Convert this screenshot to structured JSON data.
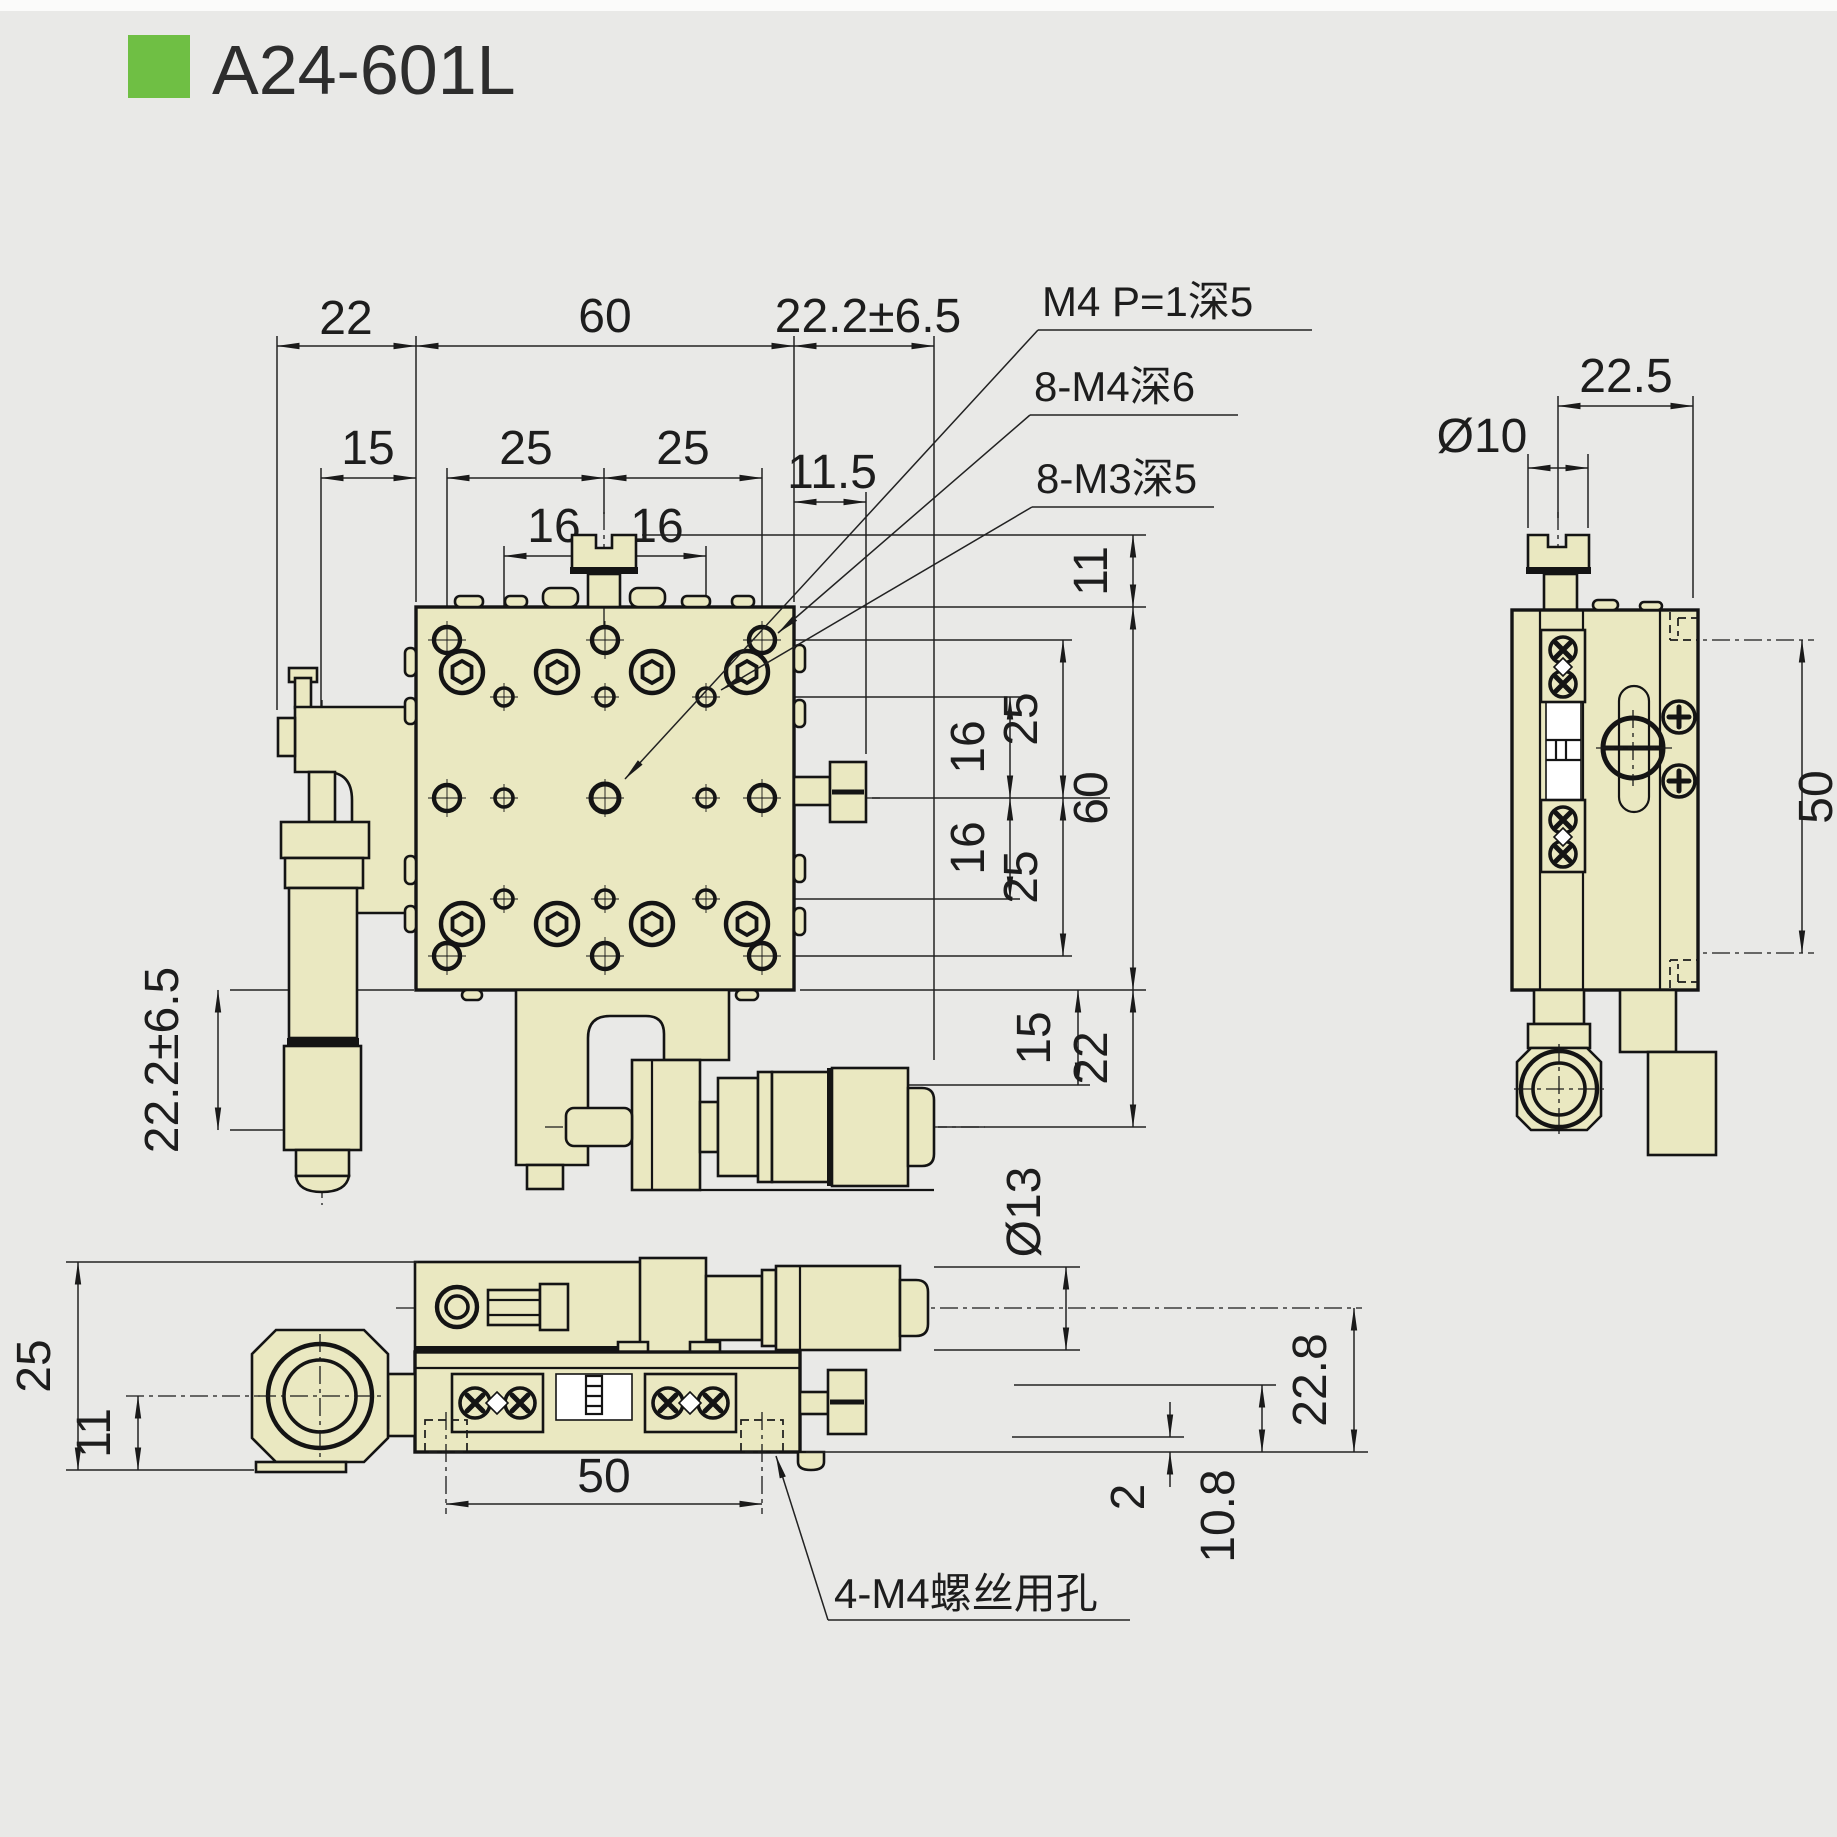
{
  "title": {
    "code": "A24-601L"
  },
  "colors": {
    "accent_green": "#6fbf44",
    "body_fill": "#eae8c1",
    "background": "#e9e9e7",
    "line": "#141414"
  },
  "front_view": {
    "top_dims": {
      "left_bracket": "22",
      "plate_width": "60",
      "travel": "22.2±6.5",
      "mic_offset": "15",
      "pitch25_a": "25",
      "pitch25_b": "25",
      "knob_offset": "11.5",
      "pitch16_a": "16",
      "pitch16_b": "16"
    },
    "right_dims": {
      "knob_height": "11",
      "pitch25_top": "25",
      "pitch16_top": "16",
      "pitch16_bottom": "16",
      "pitch25_bottom": "25",
      "plate_height": "60",
      "sub_offset": "15",
      "mic_center": "22"
    },
    "left_dims": {
      "travel": "22.2±6.5"
    },
    "callouts": {
      "center_hole": "M4 P=1深5",
      "m4_holes": "8-M4深6",
      "m3_holes": "8-M3深5"
    }
  },
  "side_view": {
    "dims": {
      "knob_offset": "22.5",
      "knob_dia": "Ø10",
      "hole_span": "50"
    }
  },
  "bottom_view": {
    "dims": {
      "height": "25",
      "knob_center": "11",
      "hole_span": "50",
      "mic_dia": "Ø13",
      "mic_center_h": "22.8",
      "step": "2",
      "hole_center_h": "10.8"
    },
    "callouts": {
      "mount_holes": "4-M4螺丝用孔"
    }
  }
}
